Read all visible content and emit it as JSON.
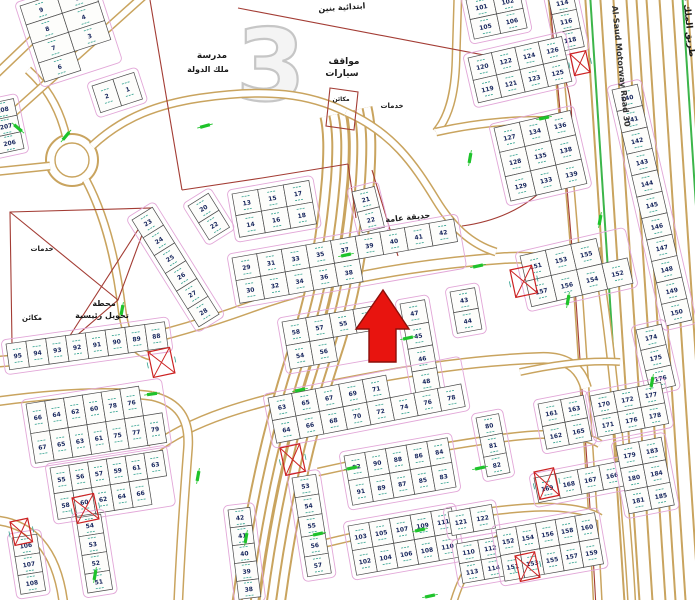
{
  "map": {
    "watermark_block_number": "3",
    "colors": {
      "road_tan": "#c9a45f",
      "road_green": "#3cb54a",
      "parcel_red": "#a33c34",
      "plot_teal": "#2fa08e",
      "setback_pink": "#e2a7d8",
      "number_navy": "#16255c",
      "arrow_red": "#e8140f"
    },
    "labels": [
      {
        "id": "school-name-1",
        "t": "مدرسة",
        "x": 212,
        "y": 58,
        "fs": 9
      },
      {
        "id": "school-name-2",
        "t": "ملك الدولة",
        "x": 208,
        "y": 72,
        "fs": 8
      },
      {
        "id": "school-type",
        "t": "ابتدائية بنين",
        "x": 342,
        "y": 10,
        "fs": 8,
        "rot": -4
      },
      {
        "id": "car-parking-1",
        "t": "مواقف",
        "x": 344,
        "y": 64,
        "fs": 9
      },
      {
        "id": "car-parking-2",
        "t": "سيارات",
        "x": 342,
        "y": 76,
        "fs": 9
      },
      {
        "id": "machines-north",
        "t": "مكائن",
        "x": 341,
        "y": 101,
        "fs": 6
      },
      {
        "id": "services-east",
        "t": "خدمات",
        "x": 392,
        "y": 108,
        "fs": 7
      },
      {
        "id": "public-garden",
        "t": "حديقة عامة",
        "x": 408,
        "y": 220,
        "fs": 8,
        "rot": -6
      },
      {
        "id": "services-west",
        "t": "خدمات",
        "x": 42,
        "y": 251,
        "fs": 7
      },
      {
        "id": "machines-west",
        "t": "مكائن",
        "x": 32,
        "y": 320,
        "fs": 7
      },
      {
        "id": "transformer-station-1",
        "t": "محطة",
        "x": 104,
        "y": 306,
        "fs": 8
      },
      {
        "id": "transformer-station-2",
        "t": "تحويل رئيسية",
        "x": 102,
        "y": 318,
        "fs": 8
      },
      {
        "id": "motorway-name-en",
        "t": "Al-Saud Motorway Road 30",
        "x": 612,
        "y": 6,
        "fs": 8,
        "rot": 84,
        "en": true
      },
      {
        "id": "motorway-name-ar",
        "t": "طريق الملك فهد السريع",
        "x": 684,
        "y": 4,
        "fs": 9,
        "rot": 84
      }
    ],
    "blocks": [
      {
        "id": "nw-grid",
        "x": 20,
        "y": 6,
        "rot": -18,
        "cw": 38,
        "ch": 20,
        "rows": [
          [
            "9",
            "5"
          ],
          [
            "8",
            "4"
          ],
          [
            "7",
            "3"
          ],
          [
            "6",
            ""
          ]
        ]
      },
      {
        "id": "nw-pair",
        "x": 92,
        "y": 86,
        "rot": -18,
        "cw": 22,
        "ch": 28,
        "rows": [
          [
            "2",
            "1"
          ]
        ]
      },
      {
        "id": "w-edge-col",
        "x": -12,
        "y": 104,
        "rot": -12,
        "cw": 26,
        "ch": 17,
        "rows": [
          [
            "208"
          ],
          [
            "207"
          ],
          [
            "206"
          ]
        ]
      },
      {
        "id": "ne-quad",
        "x": 466,
        "y": 0,
        "rot": -12,
        "cw": 27,
        "ch": 20,
        "rows": [
          [
            "101",
            "102"
          ],
          [
            "105",
            "106"
          ]
        ]
      },
      {
        "id": "ne-col",
        "x": 548,
        "y": -4,
        "rot": -12,
        "cw": 25,
        "ch": 19,
        "rows": [
          [
            "114"
          ],
          [
            "116"
          ],
          [
            "118"
          ]
        ]
      },
      {
        "id": "ne-rows",
        "x": 468,
        "y": 58,
        "rot": -13,
        "cw": 24,
        "ch": 23,
        "rows": [
          [
            "120",
            "122",
            "124",
            "126"
          ],
          [
            "119",
            "121",
            "123",
            "125"
          ]
        ]
      },
      {
        "id": "e-big",
        "x": 494,
        "y": 128,
        "rot": -13,
        "cw": 26,
        "ch": 25,
        "rows": [
          [
            "127",
            "134",
            "136"
          ],
          [
            "128",
            "135",
            "138"
          ],
          [
            "129",
            "133",
            "139"
          ]
        ]
      },
      {
        "id": "motorway-col",
        "x": 612,
        "y": 90,
        "rot": -13,
        "cw": 26,
        "ch": 22,
        "rows": [
          [
            "140"
          ],
          [
            "141"
          ],
          [
            "142"
          ],
          [
            "143"
          ],
          [
            "144"
          ],
          [
            "145"
          ],
          [
            "146"
          ],
          [
            "147"
          ],
          [
            "148"
          ],
          [
            "149"
          ],
          [
            "150"
          ]
        ]
      },
      {
        "id": "e-mid",
        "x": 520,
        "y": 256,
        "rot": -13,
        "cw": 26,
        "ch": 26,
        "rows": [
          [
            "151",
            "153",
            "155"
          ],
          [
            "157",
            "156",
            "154",
            "152"
          ]
        ]
      },
      {
        "id": "e-col-174",
        "x": 636,
        "y": 330,
        "rot": -13,
        "cw": 26,
        "ch": 21,
        "rows": [
          [
            "174"
          ],
          [
            "175"
          ],
          [
            "176"
          ]
        ]
      },
      {
        "id": "garden-col",
        "x": 352,
        "y": 192,
        "rot": -14,
        "cw": 23,
        "ch": 21,
        "rows": [
          [
            "21"
          ],
          [
            "22"
          ]
        ]
      },
      {
        "id": "c-upper",
        "x": 232,
        "y": 194,
        "rot": -10,
        "cw": 26,
        "ch": 22,
        "rows": [
          [
            "13",
            "15",
            "17"
          ],
          [
            "14",
            "16",
            "18"
          ]
        ]
      },
      {
        "id": "c-row-long",
        "x": 232,
        "y": 258,
        "rot": -10,
        "cw": 25,
        "ch": 23,
        "rows": [
          [
            "29",
            "31",
            "33",
            "35",
            "37",
            "39",
            "40",
            "41",
            "42"
          ],
          [
            "30",
            "32",
            "34",
            "36",
            "38"
          ]
        ]
      },
      {
        "id": "w-diag-col",
        "x": 132,
        "y": 220,
        "rot": -32,
        "cw": 24,
        "ch": 21,
        "rows": [
          [
            "23"
          ],
          [
            "24"
          ],
          [
            "25"
          ],
          [
            "26"
          ],
          [
            "27"
          ],
          [
            "28"
          ]
        ]
      },
      {
        "id": "w-pair-20",
        "x": 188,
        "y": 206,
        "rot": -32,
        "cw": 24,
        "ch": 20,
        "rows": [
          [
            "20"
          ],
          [
            "22"
          ]
        ]
      },
      {
        "id": "c-below-arrow",
        "x": 282,
        "y": 322,
        "rot": -10,
        "cw": 24,
        "ch": 24,
        "rows": [
          [
            "58",
            "57",
            "55",
            "53"
          ],
          [
            "54",
            "56"
          ]
        ]
      },
      {
        "id": "c-col-47",
        "x": 400,
        "y": 304,
        "rot": -10,
        "cw": 25,
        "ch": 23,
        "rows": [
          [
            "47"
          ],
          [
            "45"
          ],
          [
            "46"
          ],
          [
            "48"
          ]
        ]
      },
      {
        "id": "c-col-43",
        "x": 450,
        "y": 292,
        "rot": -10,
        "cw": 25,
        "ch": 21,
        "rows": [
          [
            "43"
          ],
          [
            "44"
          ]
        ]
      },
      {
        "id": "sw-row",
        "x": 6,
        "y": 344,
        "rot": -8,
        "cw": 20,
        "ch": 26,
        "rows": [
          [
            "95",
            "94",
            "93",
            "92",
            "91",
            "90",
            "89",
            "88"
          ]
        ]
      },
      {
        "id": "sw-grid",
        "x": 26,
        "y": 404,
        "rot": -9,
        "cw": 19,
        "ch": 30,
        "rows": [
          [
            "66",
            "64",
            "62",
            "60",
            "78",
            "76"
          ],
          [
            "67",
            "65",
            "63",
            "61",
            "75",
            "77",
            "79"
          ]
        ]
      },
      {
        "id": "sw-mid",
        "x": 50,
        "y": 468,
        "rot": -9,
        "cw": 19,
        "ch": 26,
        "rows": [
          [
            "55",
            "56",
            "57",
            "59",
            "61",
            "63"
          ],
          [
            "58",
            "60",
            "62",
            "64",
            "66"
          ]
        ]
      },
      {
        "id": "sw-col-106",
        "x": 12,
        "y": 538,
        "rot": -9,
        "cw": 25,
        "ch": 19,
        "rows": [
          [
            "106"
          ],
          [
            "107"
          ],
          [
            "108"
          ]
        ]
      },
      {
        "id": "sw-col-54",
        "x": 76,
        "y": 518,
        "rot": -9,
        "cw": 25,
        "ch": 19,
        "rows": [
          [
            "54"
          ],
          [
            "53"
          ],
          [
            "52"
          ],
          [
            "51"
          ]
        ]
      },
      {
        "id": "s-col-42",
        "x": 228,
        "y": 510,
        "rot": -7,
        "cw": 22,
        "ch": 18,
        "rows": [
          [
            "42"
          ],
          [
            "41"
          ],
          [
            "40"
          ],
          [
            "39"
          ],
          [
            "38"
          ]
        ]
      },
      {
        "id": "c-col-53",
        "x": 292,
        "y": 478,
        "rot": -9,
        "cw": 24,
        "ch": 20,
        "rows": [
          [
            "53"
          ],
          [
            "54"
          ],
          [
            "55"
          ],
          [
            "56"
          ],
          [
            "57"
          ]
        ]
      },
      {
        "id": "s-grid-63",
        "x": 268,
        "y": 398,
        "rot": -11,
        "cw": 24,
        "ch": 23,
        "rows": [
          [
            "63",
            "65",
            "67",
            "69",
            "71"
          ],
          [
            "64",
            "66",
            "68",
            "70",
            "72",
            "74",
            "76",
            "78"
          ]
        ]
      },
      {
        "id": "s-grid-92",
        "x": 344,
        "y": 456,
        "rot": -10,
        "cw": 21,
        "ch": 25,
        "rows": [
          [
            "92",
            "90",
            "88",
            "86",
            "84"
          ],
          [
            "91",
            "89",
            "87",
            "85",
            "83"
          ]
        ]
      },
      {
        "id": "s-grid-103",
        "x": 348,
        "y": 526,
        "rot": -10,
        "cw": 21,
        "ch": 25,
        "rows": [
          [
            "103",
            "105",
            "107",
            "109",
            "111"
          ],
          [
            "102",
            "104",
            "106",
            "108",
            "110"
          ]
        ]
      },
      {
        "id": "s-col-80",
        "x": 476,
        "y": 418,
        "rot": -11,
        "cw": 23,
        "ch": 20,
        "rows": [
          [
            "80"
          ],
          [
            "81"
          ],
          [
            "82"
          ]
        ]
      },
      {
        "id": "s-pair-121",
        "x": 448,
        "y": 512,
        "rot": -10,
        "cw": 22,
        "ch": 24,
        "rows": [
          [
            "121",
            "122"
          ]
        ]
      },
      {
        "id": "s-quad-110",
        "x": 456,
        "y": 544,
        "rot": -10,
        "cw": 22,
        "ch": 20,
        "rows": [
          [
            "110",
            "112"
          ],
          [
            "113",
            "114"
          ]
        ]
      },
      {
        "id": "se-grid-152",
        "x": 496,
        "y": 530,
        "rot": -10,
        "cw": 20,
        "ch": 26,
        "rows": [
          [
            "152",
            "154",
            "156",
            "158",
            "160"
          ],
          [
            "151",
            "153",
            "155",
            "157",
            "159"
          ]
        ]
      },
      {
        "id": "se-grid-161",
        "x": 538,
        "y": 404,
        "rot": -11,
        "cw": 23,
        "ch": 23,
        "rows": [
          [
            "161",
            "163"
          ],
          [
            "162",
            "165"
          ]
        ]
      },
      {
        "id": "se-row-169",
        "x": 534,
        "y": 478,
        "rot": -11,
        "cw": 22,
        "ch": 25,
        "rows": [
          [
            "169",
            "168",
            "167",
            "166",
            "164"
          ]
        ]
      },
      {
        "id": "se-grid-170",
        "x": 590,
        "y": 396,
        "rot": -11,
        "cw": 24,
        "ch": 21,
        "rows": [
          [
            "170",
            "172",
            "177"
          ],
          [
            "171",
            "176",
            "178"
          ]
        ]
      },
      {
        "id": "se-grid-179",
        "x": 616,
        "y": 446,
        "rot": -11,
        "cw": 23,
        "ch": 23,
        "rows": [
          [
            "179",
            "183"
          ],
          [
            "180",
            "184"
          ],
          [
            "181",
            "185"
          ]
        ]
      }
    ],
    "substations": [
      {
        "x": 570,
        "y": 54,
        "w": 16,
        "h": 22
      },
      {
        "x": 510,
        "y": 270,
        "w": 22,
        "h": 28
      },
      {
        "x": 148,
        "y": 352,
        "w": 22,
        "h": 26
      },
      {
        "x": 280,
        "y": 448,
        "w": 20,
        "h": 28
      },
      {
        "x": 72,
        "y": 498,
        "w": 22,
        "h": 26
      },
      {
        "x": 534,
        "y": 472,
        "w": 20,
        "h": 28
      },
      {
        "x": 515,
        "y": 556,
        "w": 20,
        "h": 26
      },
      {
        "x": 10,
        "y": 522,
        "w": 18,
        "h": 24
      }
    ],
    "green_ticks": [
      {
        "x": 18,
        "y": 128,
        "r": 40
      },
      {
        "x": 205,
        "y": 126,
        "r": -15
      },
      {
        "x": 122,
        "y": 310,
        "r": -80
      },
      {
        "x": 346,
        "y": 255,
        "r": -12
      },
      {
        "x": 408,
        "y": 338,
        "r": -12
      },
      {
        "x": 300,
        "y": 390,
        "r": -12
      },
      {
        "x": 152,
        "y": 394,
        "r": -8
      },
      {
        "x": 198,
        "y": 476,
        "r": -80
      },
      {
        "x": 246,
        "y": 538,
        "r": -80
      },
      {
        "x": 318,
        "y": 534,
        "r": -12
      },
      {
        "x": 470,
        "y": 158,
        "r": -80
      },
      {
        "x": 544,
        "y": 118,
        "r": -12
      },
      {
        "x": 480,
        "y": 468,
        "r": -12
      },
      {
        "x": 568,
        "y": 300,
        "r": -80
      },
      {
        "x": 600,
        "y": 220,
        "r": -80
      },
      {
        "x": 95,
        "y": 575,
        "r": -80
      },
      {
        "x": 420,
        "y": 530,
        "r": -12
      },
      {
        "x": 352,
        "y": 468,
        "r": -12
      },
      {
        "x": 652,
        "y": 382,
        "r": -80
      },
      {
        "x": 478,
        "y": 266,
        "r": -12
      },
      {
        "x": 430,
        "y": 596,
        "r": -12
      },
      {
        "x": 66,
        "y": 136,
        "r": -50
      }
    ]
  }
}
